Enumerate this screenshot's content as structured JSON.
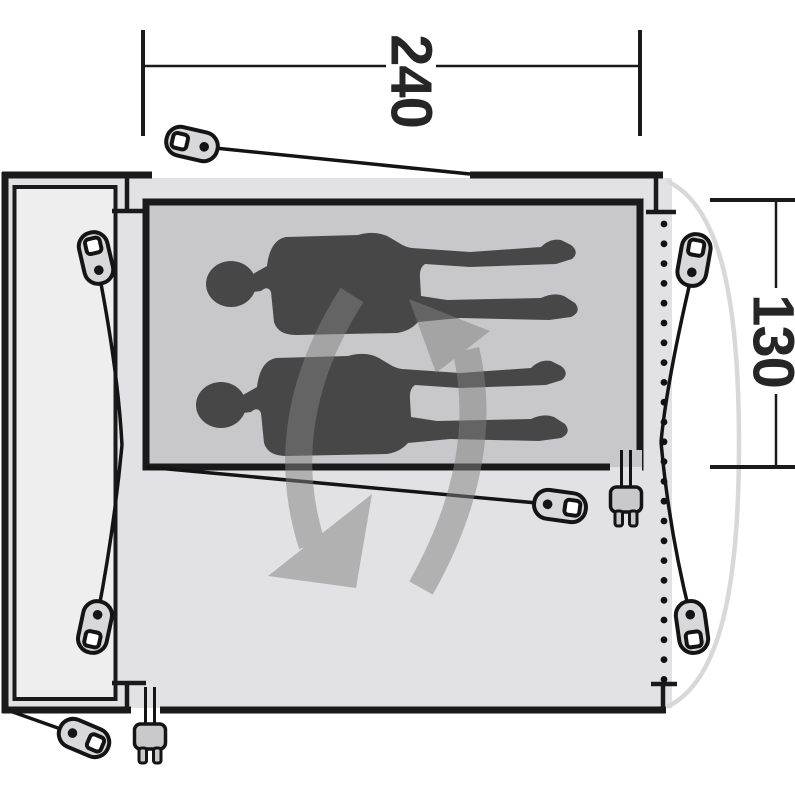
{
  "diagram": {
    "type": "tent-floorplan-top-view",
    "dimension_labels": {
      "width_label": "240",
      "height_label": "130"
    },
    "colors": {
      "background": "#ffffff",
      "outline": "#1a1a1a",
      "floor": "#e2e2e4",
      "door_panel_inner": "#eeeeef",
      "sleeping_cabin": "#c8c8ca",
      "person_silhouette": "#474747",
      "rotation_arrow": "#828282",
      "door_arc": "#d8d8d8",
      "peg_fill": "#d8d8da",
      "plug_fill": "#c9c9cb",
      "label_text": "#262626"
    },
    "icons": {
      "tent_pegs": 7,
      "power_plugs": 2,
      "persons": 2,
      "rotation_arrows": 2,
      "zipper_dots": 24
    }
  }
}
